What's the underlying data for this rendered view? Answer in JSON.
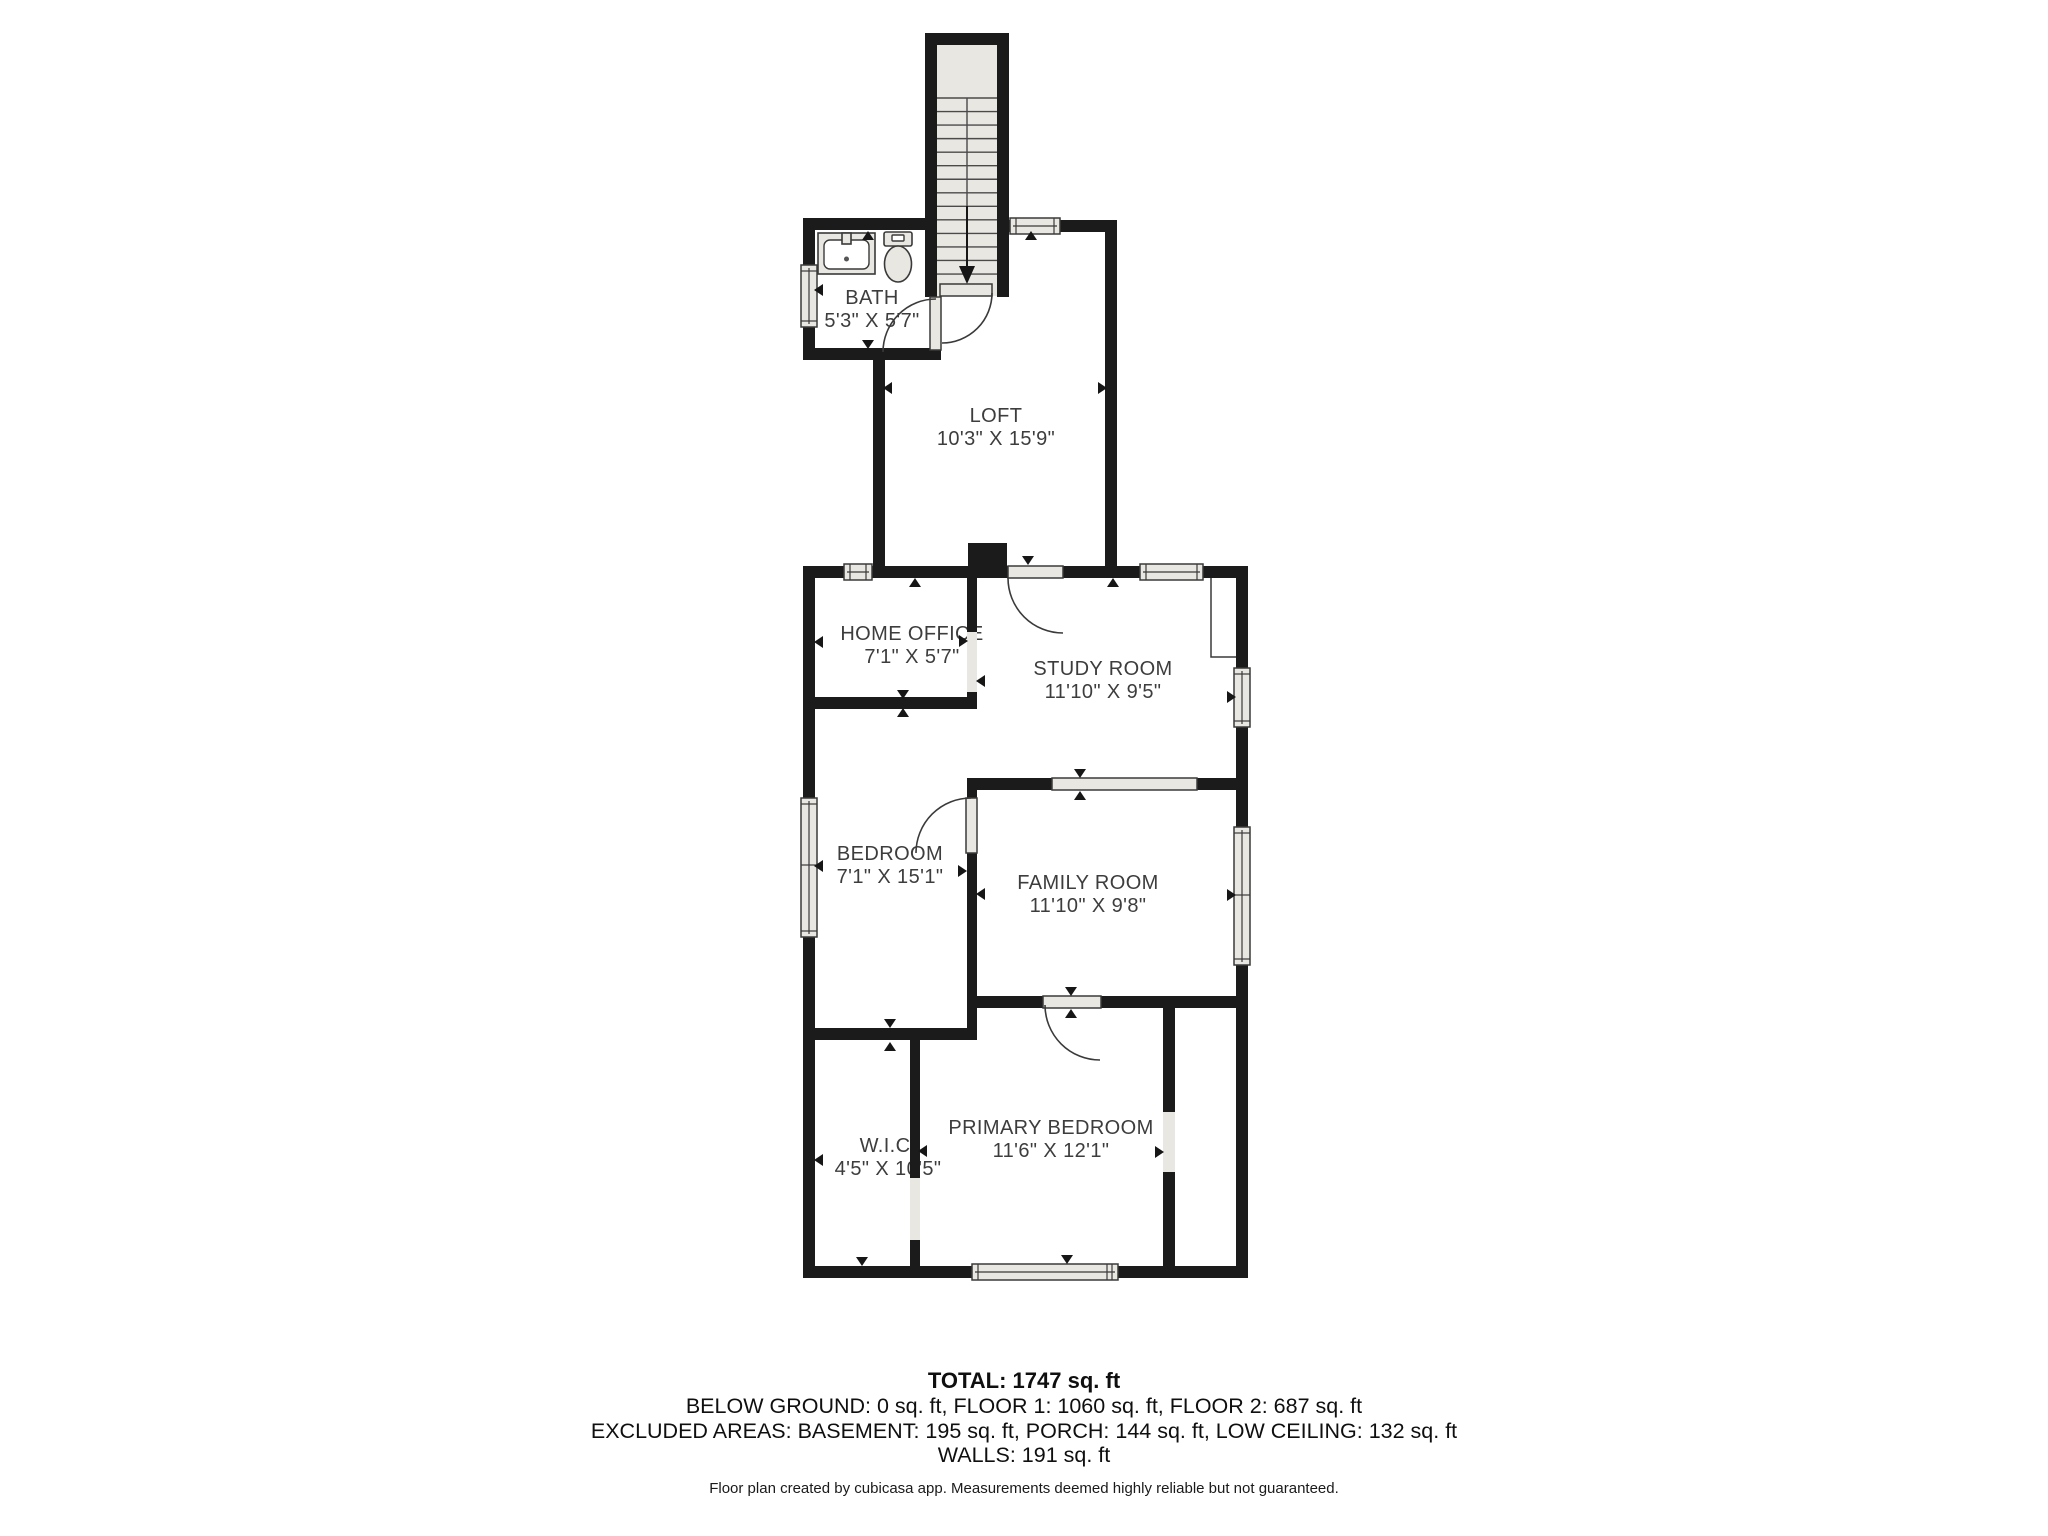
{
  "rooms": {
    "bath": {
      "name": "BATH",
      "dims": "5'3\" X 5'7\""
    },
    "loft": {
      "name": "LOFT",
      "dims": "10'3\" X 15'9\""
    },
    "home_office": {
      "name": "HOME OFFICE",
      "dims": "7'1\" X 5'7\""
    },
    "study_room": {
      "name": "STUDY ROOM",
      "dims": "11'10\" X 9'5\""
    },
    "bedroom": {
      "name": "BEDROOM",
      "dims": "7'1\" X 15'1\""
    },
    "family_room": {
      "name": "FAMILY ROOM",
      "dims": "11'10\" X 9'8\""
    },
    "wic": {
      "name": "W.I.C.",
      "dims": "4'5\" X 10'5\""
    },
    "primary_bedroom": {
      "name": "PRIMARY BEDROOM",
      "dims": "11'6\" X 12'1\""
    }
  },
  "summary": {
    "total": "TOTAL: 1747 sq. ft",
    "floors": "BELOW GROUND: 0 sq. ft, FLOOR 1: 1060 sq. ft, FLOOR 2: 687 sq. ft",
    "excluded": "EXCLUDED AREAS: BASEMENT: 195 sq. ft, PORCH: 144 sq. ft, LOW CEILING: 132 sq. ft",
    "walls": "WALLS: 191 sq. ft",
    "note": "Floor plan created by cubicasa app. Measurements deemed highly reliable but not guaranteed."
  },
  "colors": {
    "wall": "#1b1b1b",
    "fixture_fill": "#e9e7e2",
    "outline": "#3a3a3a",
    "label": "#3d3d3d",
    "floor": "#ffffff"
  }
}
